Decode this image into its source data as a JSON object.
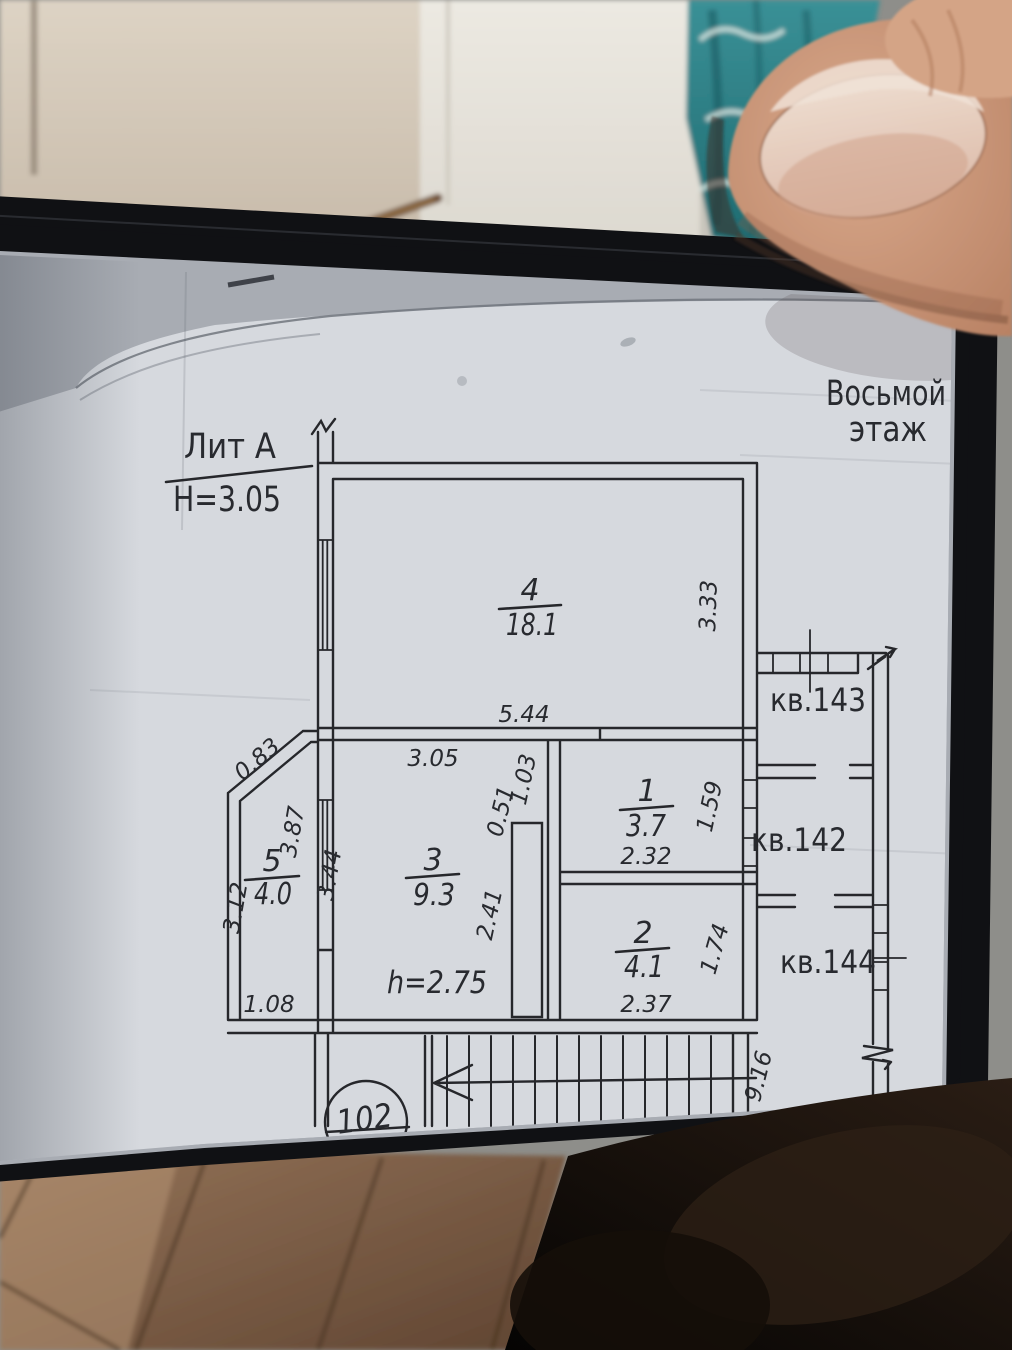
{
  "floor_header": {
    "line1": "Восьмой",
    "line2": "этаж"
  },
  "title_block": {
    "liter": "Лит А",
    "floor_height": "Н=3.05"
  },
  "rooms": {
    "r1": {
      "number": "1",
      "area": "3.7"
    },
    "r2": {
      "number": "2",
      "area": "4.1"
    },
    "r3": {
      "number": "3",
      "area": "9.3"
    },
    "r4": {
      "number": "4",
      "area": "18.1"
    },
    "r5": {
      "number": "5",
      "area": "4.0"
    }
  },
  "ceiling_height_note": "h=2.75",
  "apartments": {
    "kv143": "кв.143",
    "kv142": "кв.142",
    "kv144": "кв.144"
  },
  "dimensions": {
    "d544": "5.44",
    "d305": "3.05",
    "d333": "3.33",
    "d083": "0.83",
    "d387": "3.87",
    "d344": "3.44",
    "d312": "3.12",
    "d108": "1.08",
    "d051": "0.51",
    "d103": "1.03",
    "d241": "2.41",
    "d232": "2.32",
    "d159": "1.59",
    "d237": "2.37",
    "d174": "1.74",
    "d916": "9.16"
  },
  "stairwell": {
    "unit_number": "102"
  },
  "colors": {
    "paper": "#d6d9de",
    "ink": "#26272b",
    "phone_bezel": "#101114",
    "cloth_teal": "#2f8186",
    "skin": "#c08b70",
    "nail": "#e2c4b4",
    "wood": "#7c5c42"
  }
}
